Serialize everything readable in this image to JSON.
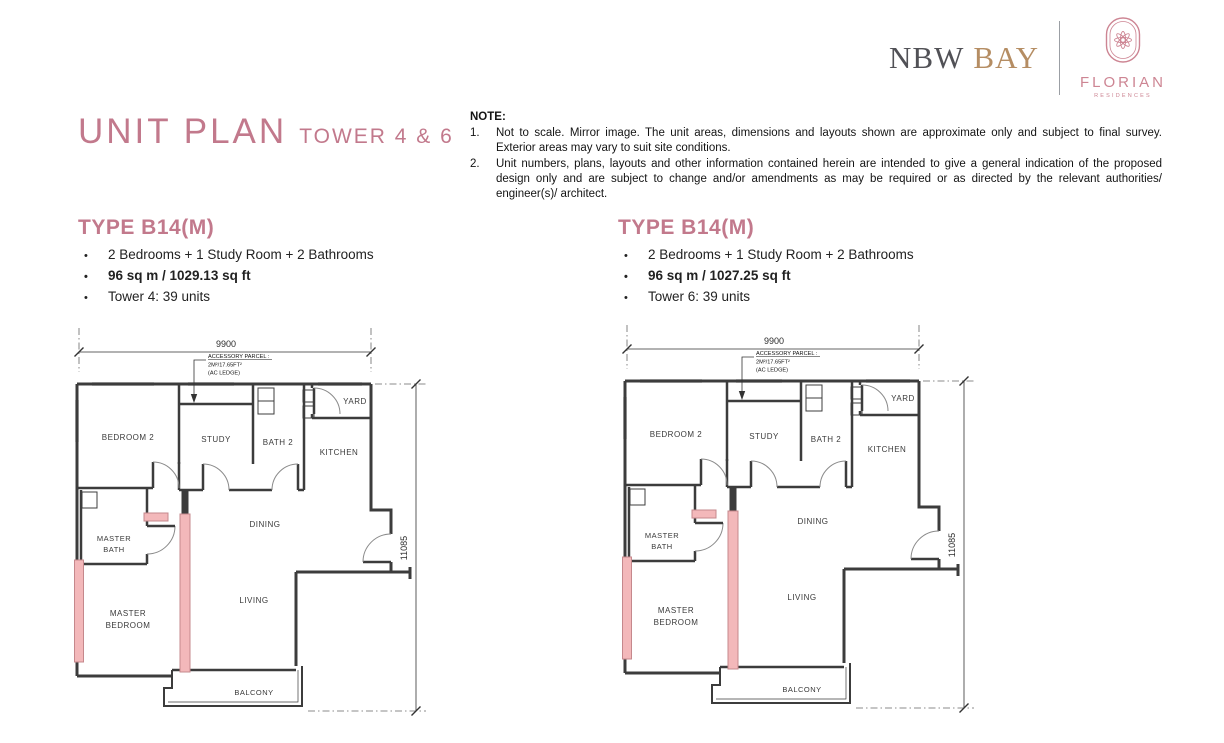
{
  "brand": {
    "nbw": "NBW",
    "bay": "BAY",
    "florian": "FLORIAN",
    "residences": "RESIDENCES"
  },
  "title": {
    "main": "UNIT PLAN",
    "sub": "TOWER 4 & 6"
  },
  "note": {
    "label": "NOTE:",
    "items": [
      {
        "num": "1.",
        "text": "Not to scale. Mirror image. The unit areas, dimensions and layouts shown are approximate only and subject to final survey. Exterior areas may vary to suit site conditions."
      },
      {
        "num": "2.",
        "text": "Unit numbers, plans, layouts and other information contained herein are intended to give a general indication of the proposed design only and are subject to change and/or amendments as may be required or as directed by the relevant authorities/ engineer(s)/ architect."
      }
    ]
  },
  "glyphs": {
    "bullet": "•"
  },
  "units": [
    {
      "heading": "TYPE B14(M)",
      "features": "2 Bedrooms + 1 Study Room + 2 Bathrooms",
      "area": "96 sq m / 1029.13 sq ft",
      "tower": "Tower 4: 39 units"
    },
    {
      "heading": "TYPE B14(M)",
      "features": "2 Bedrooms + 1 Study Room + 2 Bathrooms",
      "area": "96 sq m / 1027.25 sq ft",
      "tower": "Tower 6: 39 units"
    }
  ],
  "floor_plan": {
    "dimensions": {
      "width": "9900",
      "height": "11085"
    },
    "rooms": {
      "bedroom2": "BEDROOM 2",
      "study": "STUDY",
      "bath2": "BATH 2",
      "yard": "YARD",
      "kitchen": "KITCHEN",
      "master_bath_1": "MASTER",
      "master_bath_2": "BATH",
      "dining": "DINING",
      "living": "LIVING",
      "master_bedroom_1": "MASTER",
      "master_bedroom_2": "BEDROOM",
      "balcony": "BALCONY"
    },
    "accessory_parcel": {
      "line1": "ACCESSORY PARCEL :",
      "line2": "2M²/17.65FT²",
      "line3": "(AC LEDGE)"
    }
  },
  "colors": {
    "accent_pink": "#c2798c",
    "highlight_wall_fill": "#f3b8ba",
    "highlight_wall_edge": "#c5888c",
    "plan_line": "#3c3c3c",
    "logo_dark": "#515156",
    "logo_gold": "#b58d63",
    "logo_pink": "#cd8593"
  }
}
